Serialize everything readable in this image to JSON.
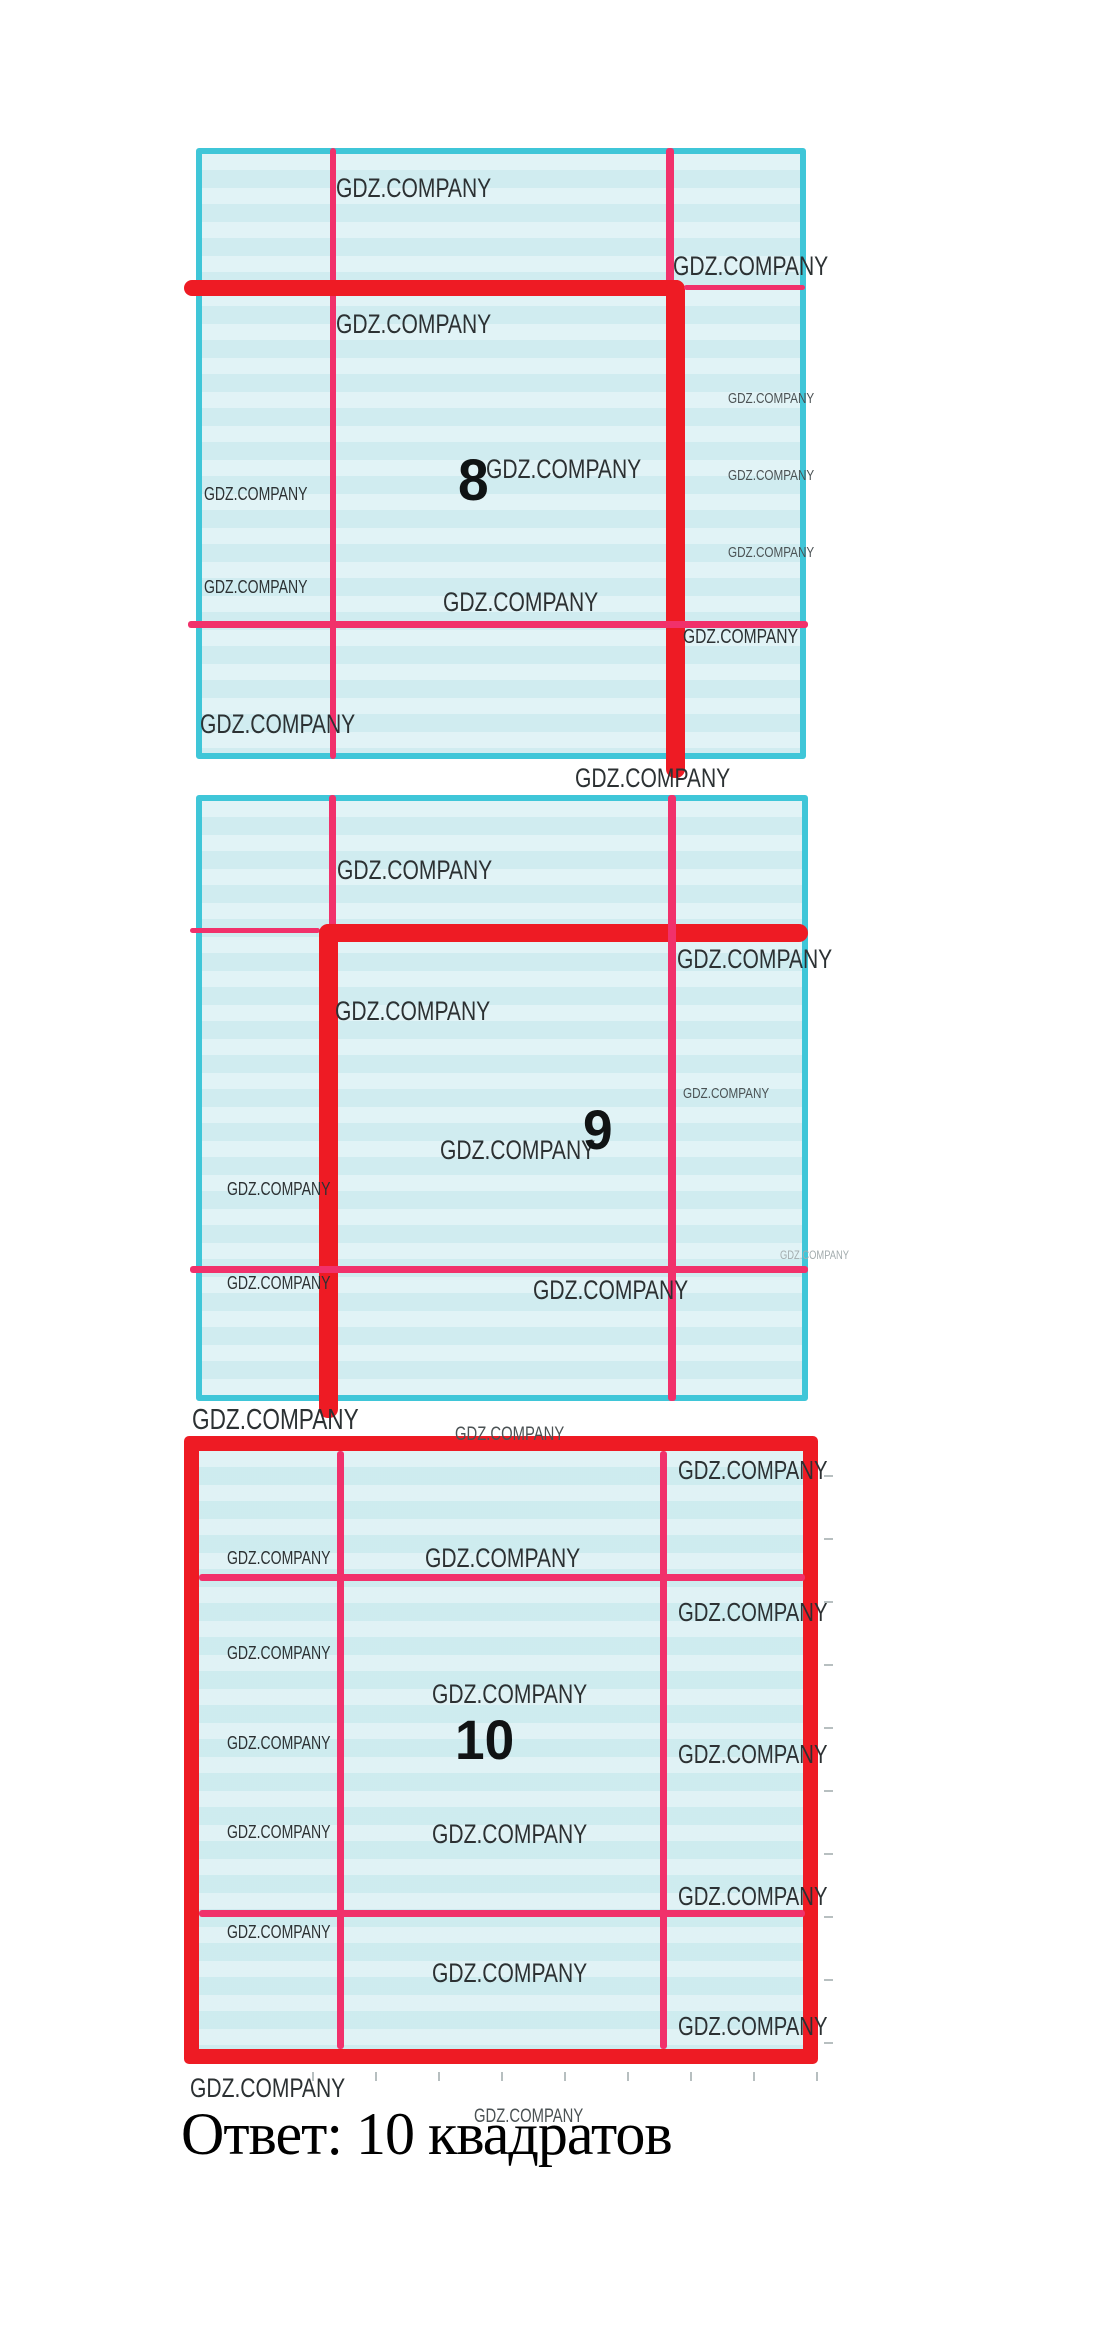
{
  "watermark": {
    "text": "GDZ.COMPANY"
  },
  "answer": {
    "text": "Ответ: 10 квадратов"
  },
  "figures": [
    {
      "number": "8"
    },
    {
      "number": "9"
    },
    {
      "number": "10"
    }
  ],
  "colors": {
    "fill": "#d9f0f3",
    "border_cyan": "#3fc6d8",
    "red": "#ee1b24",
    "pink": "#f1316b",
    "wm_dark": "#2c3133",
    "wm_mid": "#4b5254",
    "wm_light": "#a2abad",
    "tick": "#b7bfc0"
  },
  "squares": [
    {
      "x": 196,
      "y": 148,
      "w": 610,
      "h": 611,
      "kind": "cyan"
    },
    {
      "x": 196,
      "y": 795,
      "w": 612,
      "h": 606,
      "kind": "cyan"
    },
    {
      "x": 184,
      "y": 1436,
      "w": 634,
      "h": 628,
      "kind": "red"
    }
  ],
  "lines": [
    {
      "o": "v",
      "x": 330,
      "y": 148,
      "len": 611,
      "th": 6,
      "c": "pink"
    },
    {
      "o": "v",
      "x": 666,
      "y": 148,
      "len": 140,
      "th": 8,
      "c": "pink"
    },
    {
      "o": "h",
      "x": 184,
      "y": 280,
      "len": 500,
      "th": 16,
      "c": "red"
    },
    {
      "o": "v",
      "x": 666,
      "y": 280,
      "len": 498,
      "th": 19,
      "c": "red"
    },
    {
      "o": "h",
      "x": 684,
      "y": 285,
      "len": 121,
      "th": 5,
      "c": "pink"
    },
    {
      "o": "h",
      "x": 188,
      "y": 621,
      "len": 620,
      "th": 7,
      "c": "pink"
    },
    {
      "o": "v",
      "x": 329,
      "y": 795,
      "len": 134,
      "th": 7,
      "c": "pink"
    },
    {
      "o": "h",
      "x": 190,
      "y": 928,
      "len": 130,
      "th": 5,
      "c": "pink"
    },
    {
      "o": "h",
      "x": 320,
      "y": 924,
      "len": 488,
      "th": 18,
      "c": "red"
    },
    {
      "o": "v",
      "x": 319,
      "y": 924,
      "len": 494,
      "th": 19,
      "c": "red"
    },
    {
      "o": "v",
      "x": 668,
      "y": 795,
      "len": 606,
      "th": 8,
      "c": "pink"
    },
    {
      "o": "h",
      "x": 190,
      "y": 1266,
      "len": 618,
      "th": 7,
      "c": "pink"
    },
    {
      "o": "v",
      "x": 337,
      "y": 1451,
      "len": 598,
      "th": 7,
      "c": "pink"
    },
    {
      "o": "v",
      "x": 660,
      "y": 1451,
      "len": 598,
      "th": 7,
      "c": "pink"
    },
    {
      "o": "h",
      "x": 199,
      "y": 1574,
      "len": 606,
      "th": 7,
      "c": "pink"
    },
    {
      "o": "h",
      "x": 199,
      "y": 1910,
      "len": 606,
      "th": 7,
      "c": "pink"
    }
  ],
  "watermarks": [
    {
      "x": 336,
      "y": 173,
      "fs": 27,
      "c": "dark"
    },
    {
      "x": 673,
      "y": 251,
      "fs": 27,
      "c": "dark"
    },
    {
      "x": 336,
      "y": 309,
      "fs": 27,
      "c": "dark"
    },
    {
      "x": 728,
      "y": 391,
      "fs": 15,
      "c": "mid"
    },
    {
      "x": 486,
      "y": 454,
      "fs": 27,
      "c": "dark"
    },
    {
      "x": 728,
      "y": 468,
      "fs": 15,
      "c": "mid"
    },
    {
      "x": 204,
      "y": 484,
      "fs": 18,
      "c": "dark"
    },
    {
      "x": 728,
      "y": 545,
      "fs": 15,
      "c": "mid"
    },
    {
      "x": 204,
      "y": 577,
      "fs": 18,
      "c": "dark"
    },
    {
      "x": 443,
      "y": 587,
      "fs": 27,
      "c": "dark"
    },
    {
      "x": 683,
      "y": 626,
      "fs": 20,
      "c": "dark"
    },
    {
      "x": 200,
      "y": 709,
      "fs": 27,
      "c": "dark"
    },
    {
      "x": 575,
      "y": 763,
      "fs": 27,
      "c": "dark"
    },
    {
      "x": 337,
      "y": 855,
      "fs": 27,
      "c": "dark"
    },
    {
      "x": 677,
      "y": 944,
      "fs": 27,
      "c": "dark"
    },
    {
      "x": 335,
      "y": 996,
      "fs": 27,
      "c": "dark"
    },
    {
      "x": 683,
      "y": 1086,
      "fs": 15,
      "c": "mid"
    },
    {
      "x": 440,
      "y": 1135,
      "fs": 27,
      "c": "dark"
    },
    {
      "x": 227,
      "y": 1179,
      "fs": 18,
      "c": "dark"
    },
    {
      "x": 780,
      "y": 1249,
      "fs": 12,
      "c": "light"
    },
    {
      "x": 227,
      "y": 1273,
      "fs": 18,
      "c": "dark"
    },
    {
      "x": 533,
      "y": 1275,
      "fs": 27,
      "c": "dark"
    },
    {
      "x": 192,
      "y": 1404,
      "fs": 29,
      "c": "dark"
    },
    {
      "x": 455,
      "y": 1424,
      "fs": 19,
      "c": "mid"
    },
    {
      "x": 678,
      "y": 1456,
      "fs": 26,
      "c": "dark"
    },
    {
      "x": 425,
      "y": 1543,
      "fs": 27,
      "c": "dark"
    },
    {
      "x": 227,
      "y": 1548,
      "fs": 18,
      "c": "dark"
    },
    {
      "x": 678,
      "y": 1598,
      "fs": 26,
      "c": "dark"
    },
    {
      "x": 227,
      "y": 1643,
      "fs": 18,
      "c": "dark"
    },
    {
      "x": 432,
      "y": 1679,
      "fs": 27,
      "c": "dark"
    },
    {
      "x": 227,
      "y": 1733,
      "fs": 18,
      "c": "dark"
    },
    {
      "x": 678,
      "y": 1740,
      "fs": 26,
      "c": "dark"
    },
    {
      "x": 432,
      "y": 1819,
      "fs": 27,
      "c": "dark"
    },
    {
      "x": 227,
      "y": 1822,
      "fs": 18,
      "c": "dark"
    },
    {
      "x": 678,
      "y": 1882,
      "fs": 26,
      "c": "dark"
    },
    {
      "x": 227,
      "y": 1922,
      "fs": 18,
      "c": "dark"
    },
    {
      "x": 432,
      "y": 1958,
      "fs": 27,
      "c": "dark"
    },
    {
      "x": 678,
      "y": 2012,
      "fs": 26,
      "c": "dark"
    },
    {
      "x": 190,
      "y": 2073,
      "fs": 27,
      "c": "dark"
    },
    {
      "x": 474,
      "y": 2106,
      "fs": 19,
      "c": "mid"
    }
  ],
  "numbers": [
    {
      "text": "8",
      "x": 458,
      "y": 452,
      "fs": 58
    },
    {
      "text": "9",
      "x": 583,
      "y": 1102,
      "fs": 56
    },
    {
      "text": "10",
      "x": 455,
      "y": 1712,
      "fs": 56
    }
  ],
  "ticks": {
    "right": {
      "x": 824,
      "ys": [
        1475,
        1538,
        1601,
        1664,
        1727,
        1790,
        1853,
        1916,
        1979,
        2042
      ]
    },
    "bottom": {
      "y": 2072,
      "xs": [
        312,
        375,
        438,
        501,
        564,
        627,
        690,
        753,
        816
      ]
    }
  }
}
